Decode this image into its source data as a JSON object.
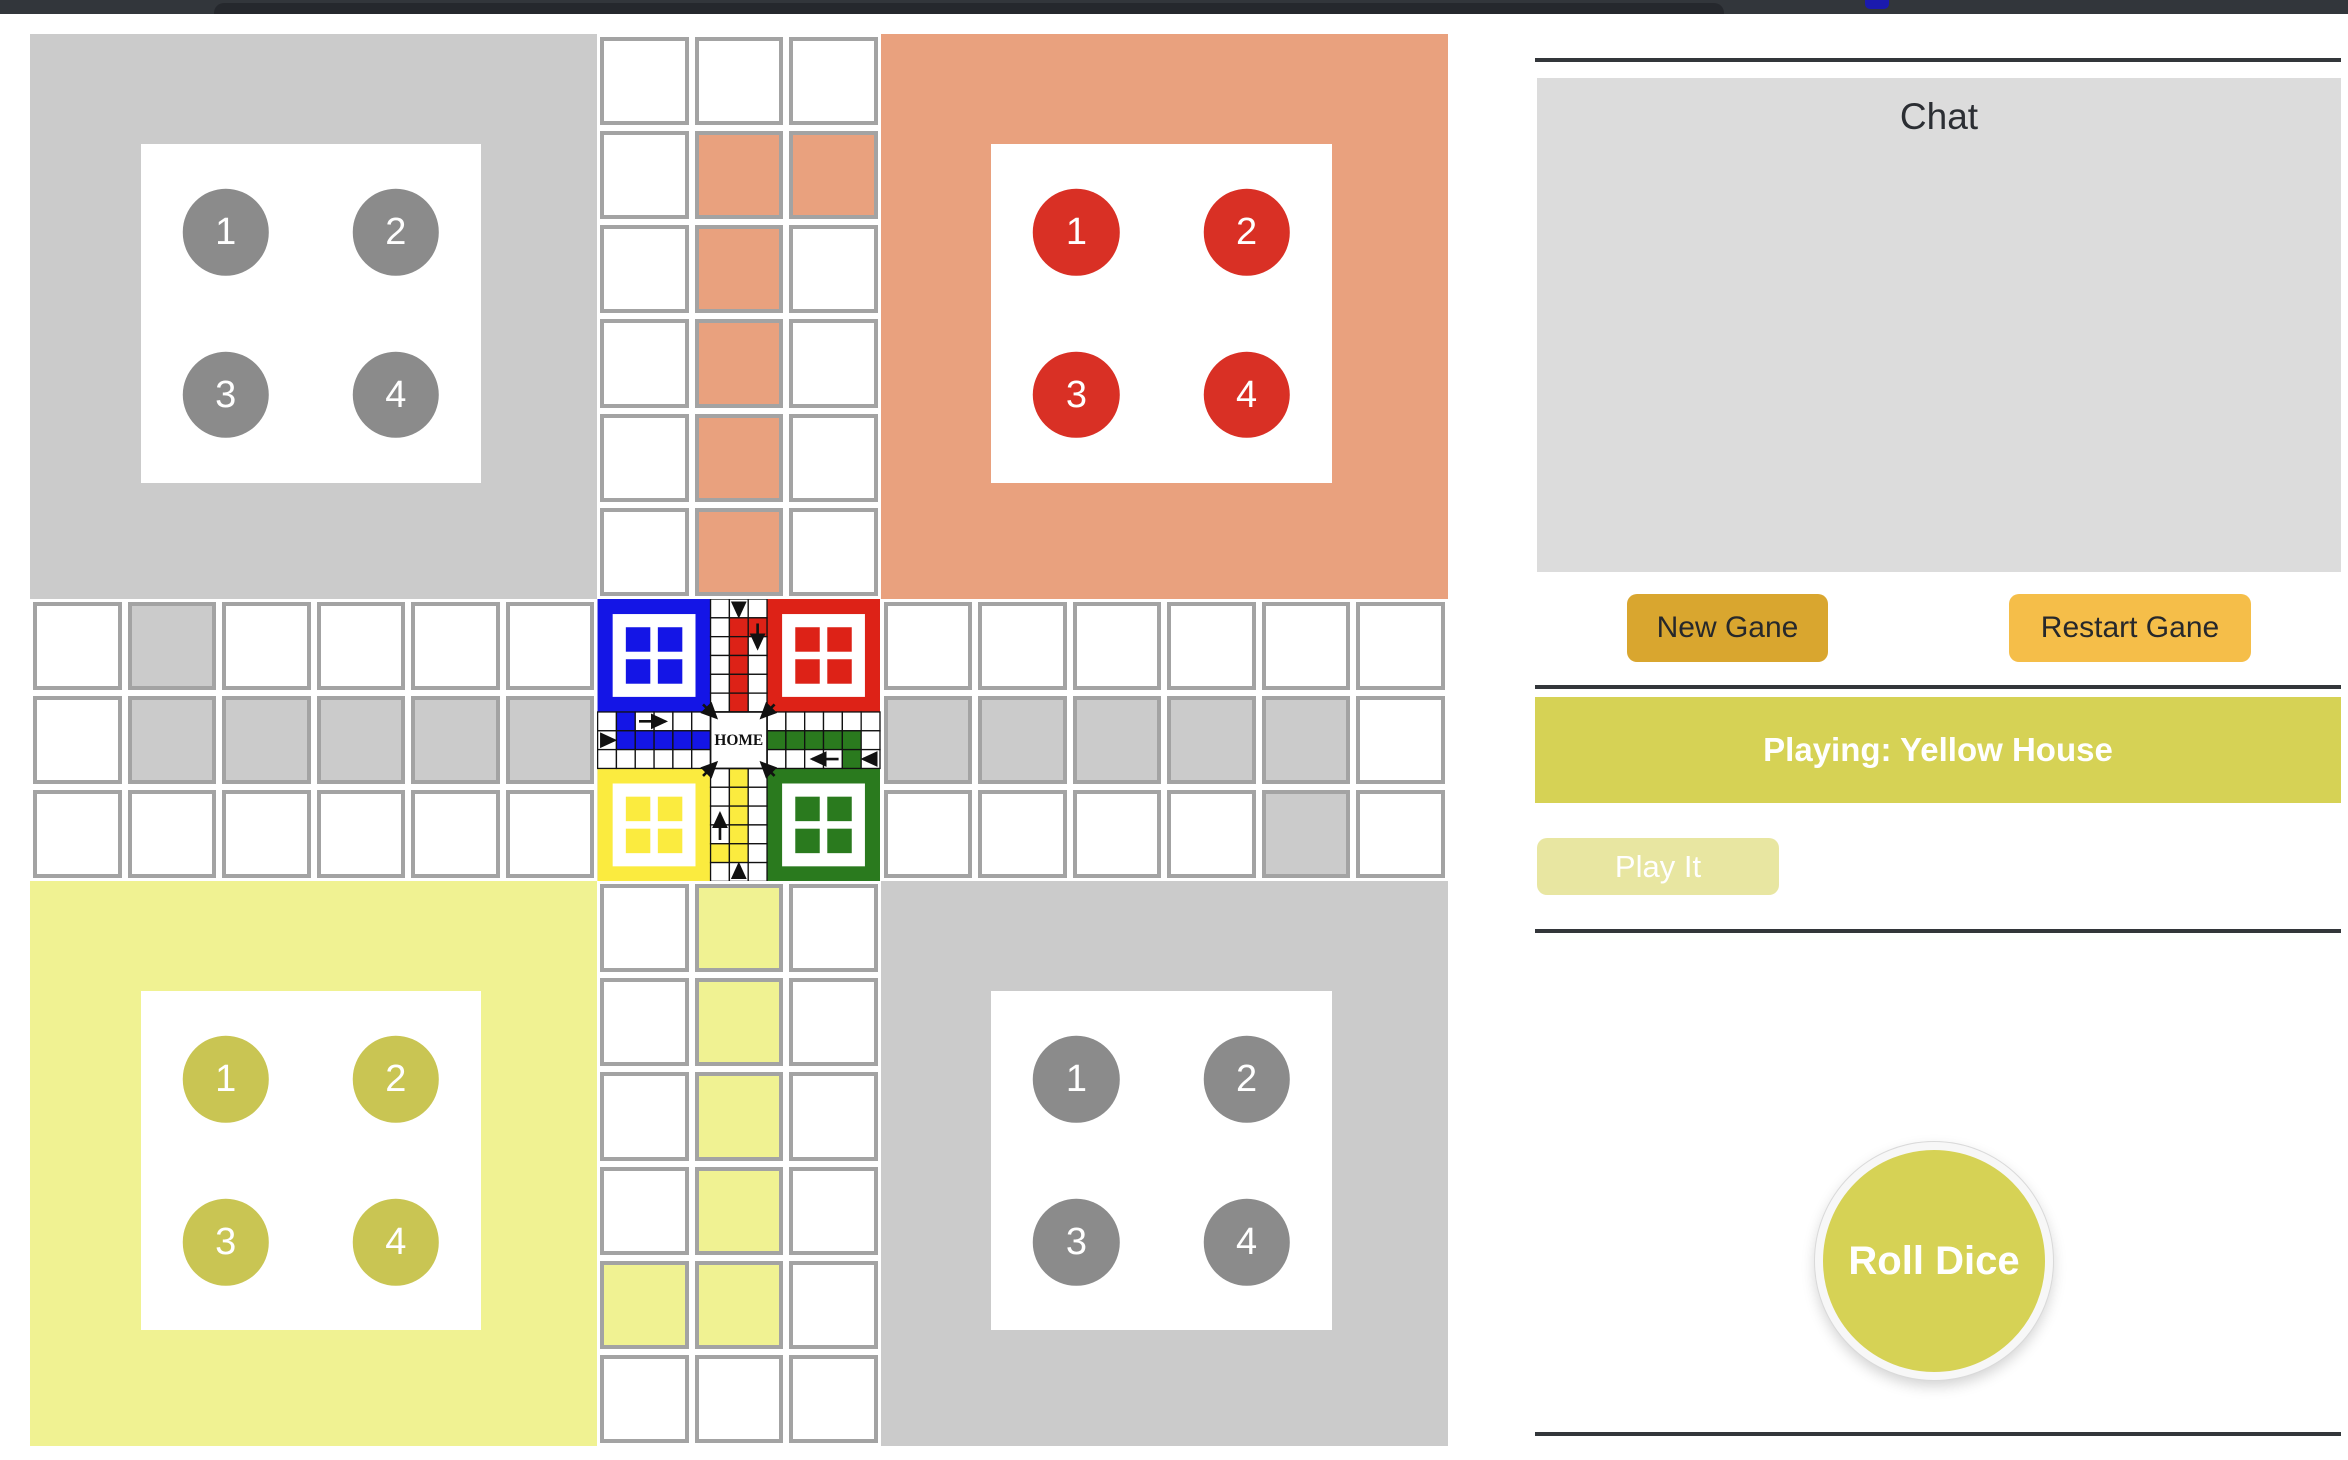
{
  "top_bar": {
    "description": "dark browser chrome sliver with blue accent tab marker"
  },
  "board": {
    "grid_size": 15,
    "center_label": "HOME",
    "quadrants": [
      {
        "id": "top-left",
        "color": "#CBCBCB",
        "piece_color": "#8B8B8B",
        "pieces": [
          "1",
          "2",
          "3",
          "4"
        ]
      },
      {
        "id": "top-right",
        "color": "#E9A17E",
        "piece_color": "#D93025",
        "pieces": [
          "1",
          "2",
          "3",
          "4"
        ]
      },
      {
        "id": "bottom-left",
        "color": "#F0F292",
        "piece_color": "#C9C553",
        "pieces": [
          "1",
          "2",
          "3",
          "4"
        ]
      },
      {
        "id": "bottom-right",
        "color": "#CBCBCB",
        "piece_color": "#8B8B8B",
        "pieces": [
          "1",
          "2",
          "3",
          "4"
        ]
      }
    ],
    "path_colors": {
      "silver": "#CBCBCB",
      "salmon": "#E9A17E",
      "yellow": "#F0F292"
    },
    "colored_cells": [
      {
        "row": 2,
        "col": 8,
        "color": "salmon"
      },
      {
        "row": 2,
        "col": 9,
        "color": "salmon"
      },
      {
        "row": 3,
        "col": 8,
        "color": "salmon"
      },
      {
        "row": 4,
        "col": 8,
        "color": "salmon"
      },
      {
        "row": 5,
        "col": 8,
        "color": "salmon"
      },
      {
        "row": 6,
        "col": 8,
        "color": "salmon"
      },
      {
        "row": 7,
        "col": 2,
        "color": "silver"
      },
      {
        "row": 8,
        "col": 2,
        "color": "silver"
      },
      {
        "row": 8,
        "col": 3,
        "color": "silver"
      },
      {
        "row": 8,
        "col": 4,
        "color": "silver"
      },
      {
        "row": 8,
        "col": 5,
        "color": "silver"
      },
      {
        "row": 8,
        "col": 6,
        "color": "silver"
      },
      {
        "row": 8,
        "col": 10,
        "color": "silver"
      },
      {
        "row": 8,
        "col": 11,
        "color": "silver"
      },
      {
        "row": 8,
        "col": 12,
        "color": "silver"
      },
      {
        "row": 8,
        "col": 13,
        "color": "silver"
      },
      {
        "row": 8,
        "col": 14,
        "color": "silver"
      },
      {
        "row": 9,
        "col": 14,
        "color": "silver"
      },
      {
        "row": 10,
        "col": 8,
        "color": "yellow"
      },
      {
        "row": 11,
        "col": 8,
        "color": "yellow"
      },
      {
        "row": 12,
        "col": 8,
        "color": "yellow"
      },
      {
        "row": 13,
        "col": 8,
        "color": "yellow"
      },
      {
        "row": 14,
        "col": 8,
        "color": "yellow"
      },
      {
        "row": 14,
        "col": 7,
        "color": "yellow"
      }
    ],
    "center_image_colors": {
      "blue": "#1415E6",
      "red": "#DD2217",
      "green": "#2A7A1E",
      "yellow": "#FBEB3F"
    }
  },
  "panel": {
    "chat_title": "Chat",
    "new_game_label": "New Gane",
    "restart_game_label": "Restart Gane",
    "status_banner": "Playing: Yellow House",
    "play_button_label": "Play It",
    "roll_dice_label": "Roll Dice"
  },
  "colors": {
    "chrome_bar": "#32363B",
    "chrome_tab": "#25282D",
    "chrome_accent": "#1B1AAE",
    "cell_border": "#A3A3A3",
    "chat_bg": "#DCDCDC",
    "divider": "#33363A",
    "accent_gold": "#D9A62F",
    "accent_orange": "#F5BE49",
    "accent_yellowgreen": "#D6D255"
  }
}
